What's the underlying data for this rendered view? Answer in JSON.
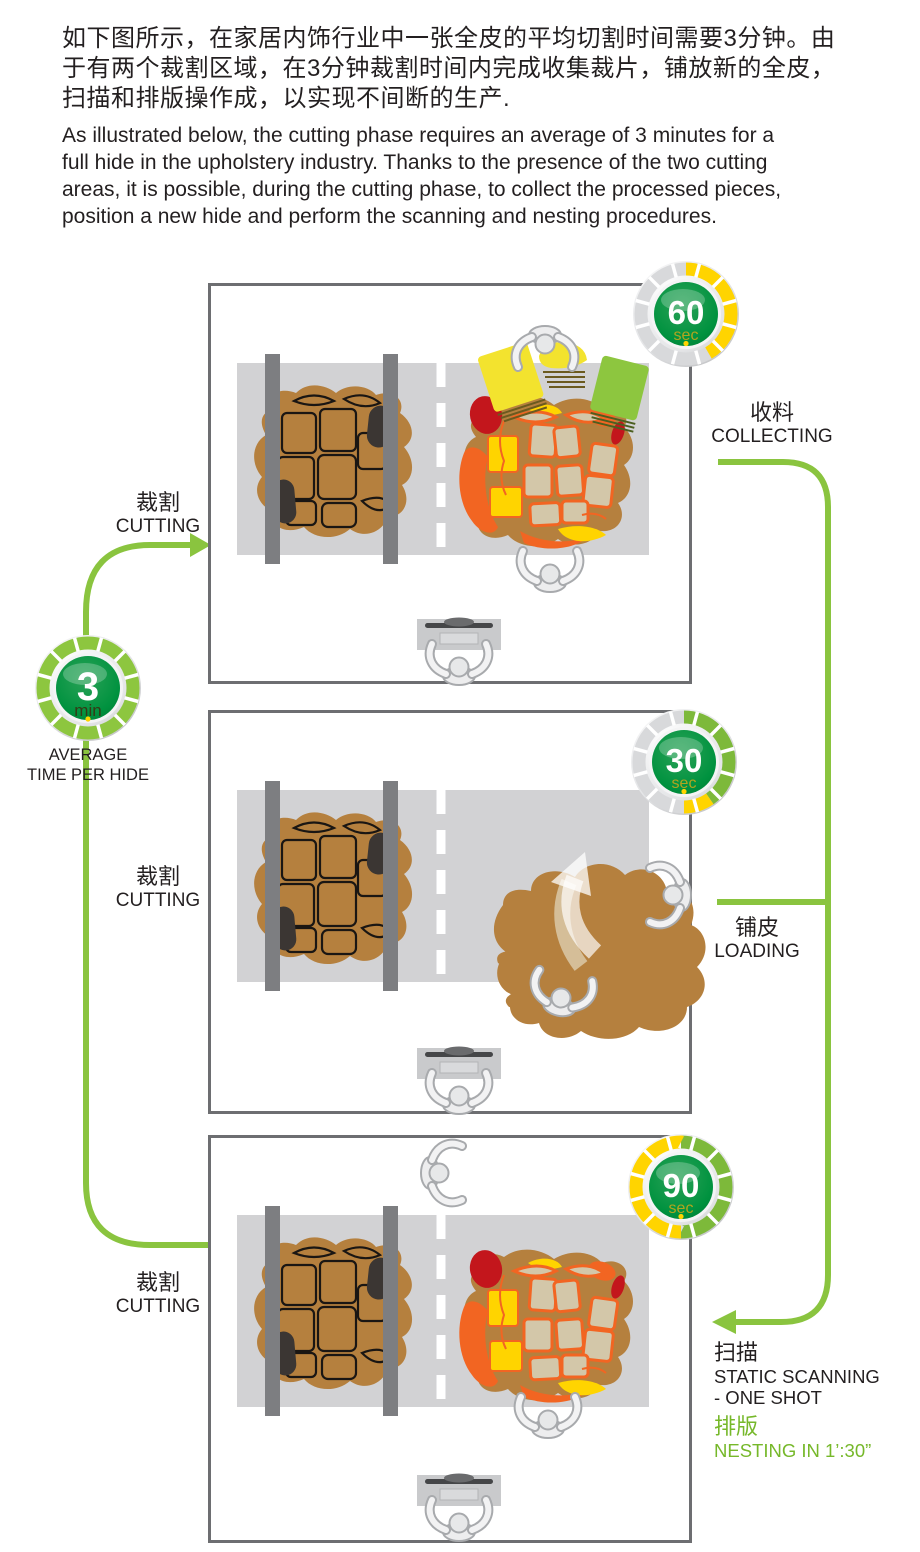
{
  "intro": {
    "zh_lines": [
      "如下图所示，在家居内饰行业中一张全皮的平均切割时间需要3分钟。由",
      "于有两个裁割区域，在3分钟裁割时间内完成收集裁片，铺放新的全皮，",
      "扫描和排版操作成，以实现不间断的生产."
    ],
    "en_lines": [
      "As illustrated below, the cutting phase requires an average of  3 minutes for a",
      "full hide in the upholstery industry. Thanks to the presence of the two cutting",
      "areas, it is possible, during the cutting phase, to collect the processed pieces,",
      "position a new hide and perform the scanning and nesting procedures."
    ]
  },
  "average_badge": {
    "value": "3",
    "unit": "min",
    "caption_line1": "AVERAGE",
    "caption_line2": "TIME PER HIDE"
  },
  "timers": [
    {
      "value": "60",
      "unit": "sec"
    },
    {
      "value": "30",
      "unit": "sec"
    },
    {
      "value": "90",
      "unit": "sec"
    }
  ],
  "labels": {
    "cutting1": {
      "zh": "裁割",
      "en": "CUTTING"
    },
    "collecting": {
      "zh": "收料",
      "en": "COLLECTING"
    },
    "cutting2": {
      "zh": "裁割",
      "en": "CUTTING"
    },
    "loading": {
      "zh": "铺皮",
      "en": "LOADING"
    },
    "cutting3": {
      "zh": "裁割",
      "en": "CUTTING"
    },
    "scanning": {
      "zh": "扫描",
      "en_line1": "STATIC SCANNING",
      "en_line2": " - ONE SHOT"
    },
    "nesting": {
      "zh": "排版",
      "en": "NESTING IN 1’:30”"
    }
  },
  "colors": {
    "accent_green": "#8ac43f",
    "text_green": "#76b82a",
    "timer_green": "#00923f",
    "timer_yellow": "#ffd400",
    "hide_brown": "#b5803e",
    "piece_orange": "#f26522",
    "piece_red": "#c3161c",
    "piece_beige": "#d3c7a9",
    "table_gray": "#d2d2d4",
    "panel_border": "#6d6e71",
    "text_dark": "#231f20"
  }
}
